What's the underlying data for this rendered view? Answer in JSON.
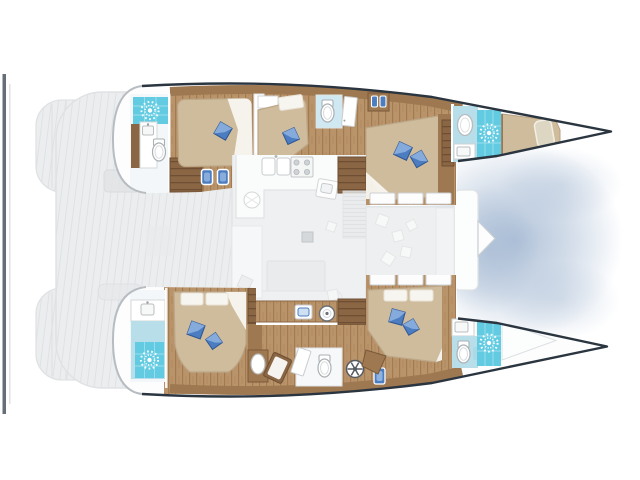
{
  "title": "Catamaran yacht interior deck plan (top view, bow right)",
  "diagram_type": "floor-plan",
  "colors": {
    "white": "#ffffff",
    "hull_fill": "#fdfdfe",
    "outline_dark": "#2a3540",
    "cap_gray": "#b6bcc1",
    "deck_faded": "#ebedee",
    "deck_plank_line": "#dfe2e4",
    "salon_floor": "#eff0f1",
    "counter_white": "#fafbfb",
    "gray_line": "#c9ccce",
    "wood_floor": "#b9936a",
    "wood_floor_dark": "#a37b51",
    "wood_mid": "#9e7850",
    "wood_dark": "#8a6644",
    "wood_dark_line": "#6e4f33",
    "bed_tan": "#cfbc9d",
    "bed_edge": "#bca788",
    "bed_white": "#f7f5ef",
    "pillow_blue": "#4c7dc0",
    "pillow_blue_light": "#8fb3e0",
    "pillow_edge": "#2e5692",
    "shower_cyan": "#62cbe2",
    "shower_grout": "#a8e2ef",
    "bath_blue": "#b8dfe9",
    "bath_blue_light": "#cfe8f1",
    "water_shadow": "#9db3cf",
    "fitting_gray": "#d5d8da",
    "davit_bar": "#4b565f"
  },
  "icons": {
    "shower": "white sunburst rose on cyan tile",
    "toilet": "white oval bowl with tank",
    "sink": "white rounded rectangle basin with faucet dot",
    "round_basin": "white circle with center dot",
    "stove": "four gray burner circles",
    "pillow": "blue two-tone diamond cushion",
    "stool": "blue rectangle with white border",
    "washing_machine": "white circle with dark spokes",
    "bottles": "small blue bottles on shelf"
  },
  "regions": {
    "port_hull": [
      "aft-bathroom",
      "aft-cabin",
      "mid-cabin",
      "mid-bathroom",
      "bottle-shelf",
      "forward-cabin",
      "bow-bathroom",
      "forepeak-berth"
    ],
    "starboard_hull": [
      "aft-bathroom",
      "aft-cabin",
      "corridor-vanity",
      "mid-bathroom",
      "forward-cabin",
      "bow-bathroom",
      "bow-locker"
    ],
    "bridgedeck": [
      "galley",
      "dinette",
      "nav-seat",
      "utility-cabinet-row",
      "companionway-steps",
      "forward-lounge",
      "forward-cockpit",
      "bowsprit"
    ],
    "aft": [
      "aft-deck",
      "transom-steps-port",
      "transom-steps-starboard",
      "davit-bar"
    ]
  }
}
